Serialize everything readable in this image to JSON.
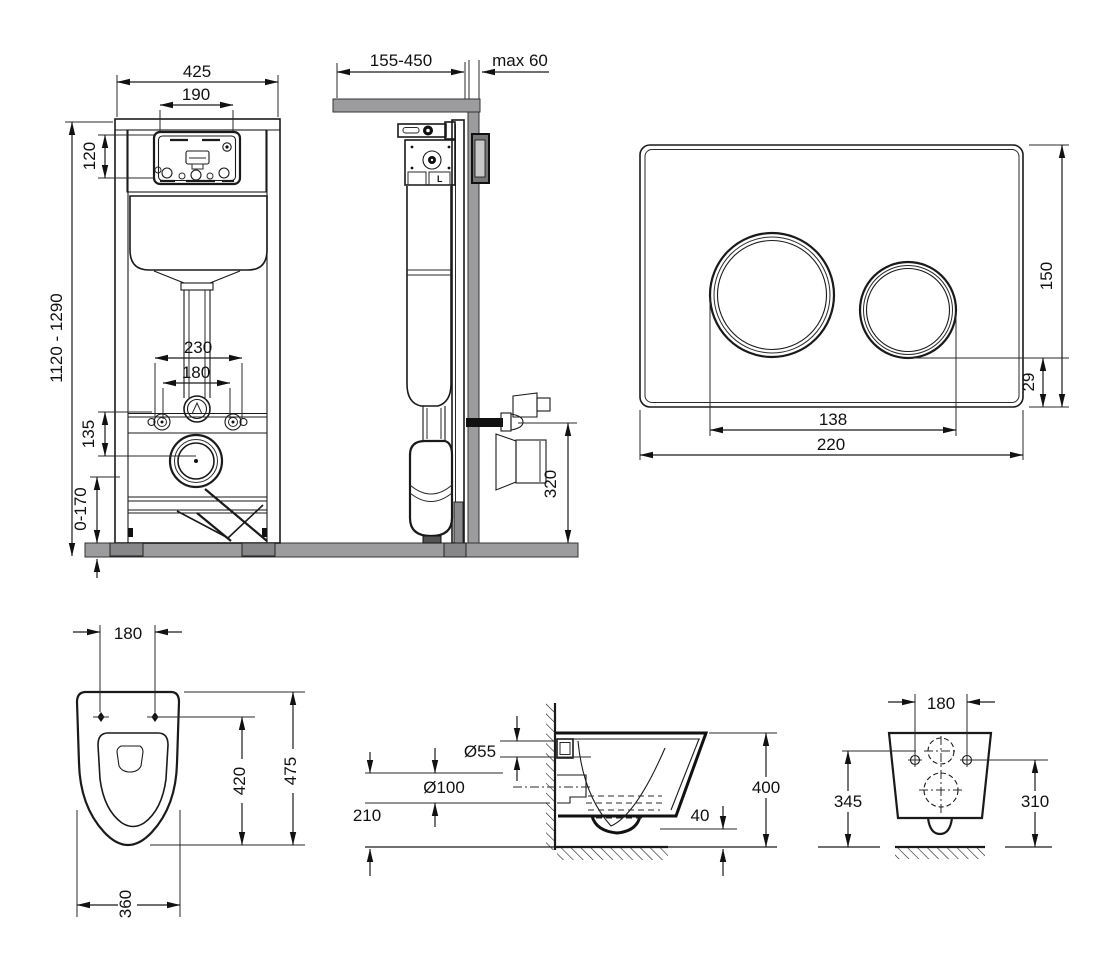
{
  "views": {
    "frame_front": {
      "width": "425",
      "cutout_width": "190",
      "cutout_height": "120",
      "install_height": "1120 - 1290",
      "fixing_outer": "230",
      "fixing_inner": "180",
      "drain_offset": "135",
      "adjust_range": "0-170"
    },
    "frame_side": {
      "depth_range": "155-450",
      "wall_thickness": "max 60",
      "drain_height": "320",
      "valve_label": "L"
    },
    "flush_plate": {
      "height": "150",
      "bottom_gap": "29",
      "button_span": "138",
      "width": "220"
    },
    "bowl_top": {
      "bolt_span": "180",
      "seat_depth": "420",
      "depth": "475",
      "width": "360"
    },
    "bowl_side": {
      "inlet_dia": "Ø55",
      "outlet_dia": "Ø100",
      "outlet_height": "210",
      "water_depth": "40",
      "height": "400"
    },
    "bowl_front": {
      "bolt_span": "180",
      "height_left": "345",
      "height_right": "310"
    }
  }
}
